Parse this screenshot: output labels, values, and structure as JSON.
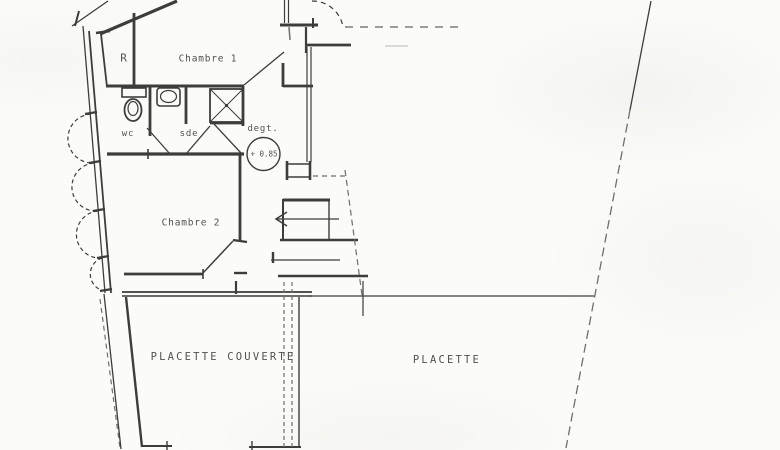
{
  "meta": {
    "drawing_type": "architectural floor plan (scanned hand drawing)",
    "language": "French"
  },
  "colors": {
    "paper": "#fbfbf9",
    "ink": "#3d3d3b",
    "ink_soft": "#6f6e6a",
    "text": "#45443f"
  },
  "labels": {
    "room_r": "R",
    "chambre1": "Chambre 1",
    "wc": "wc",
    "sde": "sde",
    "degt": "degt.",
    "level": "+ 0.85",
    "chambre2": "Chambre 2",
    "placette_couverte": "PLACETTE COUVERTE",
    "placette": "PLACETTE"
  }
}
